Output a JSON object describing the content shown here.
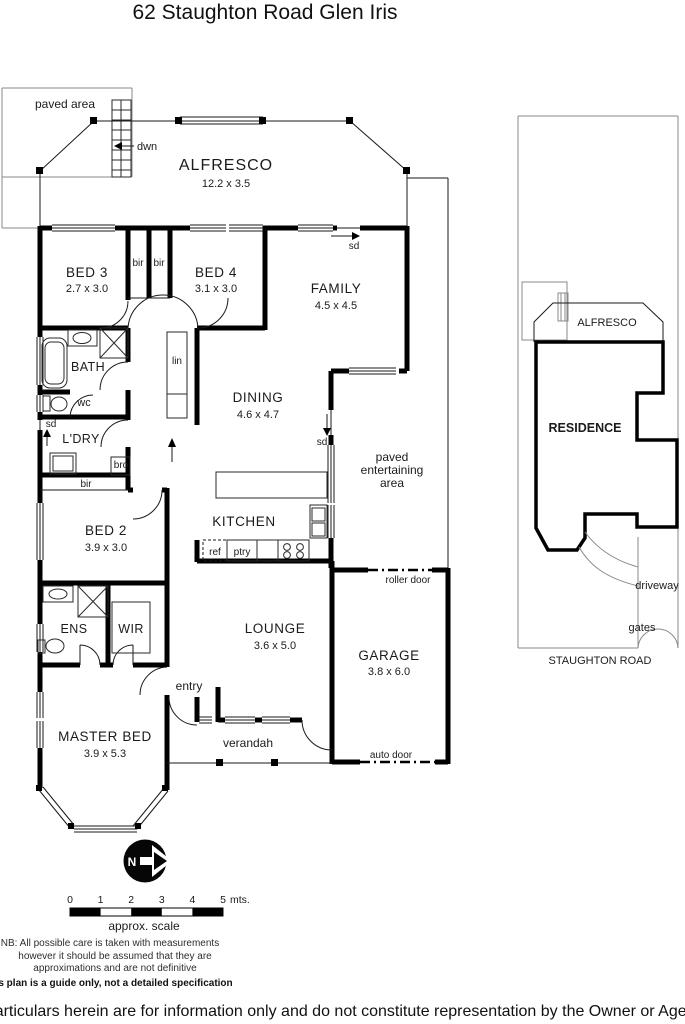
{
  "title": "62 Staughton Road Glen Iris",
  "plan": {
    "rooms": {
      "alfresco": {
        "name": "ALFRESCO",
        "dims": "12.2 x 3.5"
      },
      "bed3": {
        "name": "BED 3",
        "dims": "2.7 x 3.0"
      },
      "bed4": {
        "name": "BED 4",
        "dims": "3.1 x 3.0"
      },
      "family": {
        "name": "FAMILY",
        "dims": "4.5 x 4.5"
      },
      "bath": {
        "name": "BATH"
      },
      "wc": {
        "name": "wc"
      },
      "ldry": {
        "name": "L'DRY"
      },
      "bed2": {
        "name": "BED 2",
        "dims": "3.9 x 3.0"
      },
      "dining": {
        "name": "DINING",
        "dims": "4.6 x 4.7"
      },
      "kitchen": {
        "name": "KITCHEN"
      },
      "lounge": {
        "name": "LOUNGE",
        "dims": "3.6 x 5.0"
      },
      "garage": {
        "name": "GARAGE",
        "dims": "3.8 x 6.0"
      },
      "ens": {
        "name": "ENS"
      },
      "wir": {
        "name": "WIR"
      },
      "master": {
        "name": "MASTER BED",
        "dims": "3.9 x 5.3"
      }
    },
    "labels": {
      "paved_area": "paved area",
      "dwn": "dwn",
      "sd": "sd",
      "bir": "bir",
      "lin": "lin",
      "bro": "bro",
      "ref": "ref",
      "ptry": "ptry",
      "entry": "entry",
      "verandah": "verandah",
      "roller_door": "roller door",
      "auto_door": "auto door",
      "paved_entertaining_1": "paved",
      "paved_entertaining_2": "entertaining",
      "paved_entertaining_3": "area"
    }
  },
  "site": {
    "alfresco": "ALFRESCO",
    "residence": "RESIDENCE",
    "driveway": "driveway",
    "gates": "gates",
    "road": "STAUGHTON ROAD"
  },
  "compass": {
    "north": "N"
  },
  "scale_bar": {
    "ticks": [
      "0",
      "1",
      "2",
      "3",
      "4",
      "5"
    ],
    "unit": "mts.",
    "caption": "approx. scale"
  },
  "notes": {
    "nb_line1": "NB:  All possible care is taken with measurements",
    "nb_line2": "however it should be assumed that they are",
    "nb_line3": "approximations and are not definitive",
    "disclaimer_bold": "This plan is a guide only, not a detailed specification"
  },
  "footer": "Particulars herein are for information only and do not constitute representation by the Owner or Agent"
}
